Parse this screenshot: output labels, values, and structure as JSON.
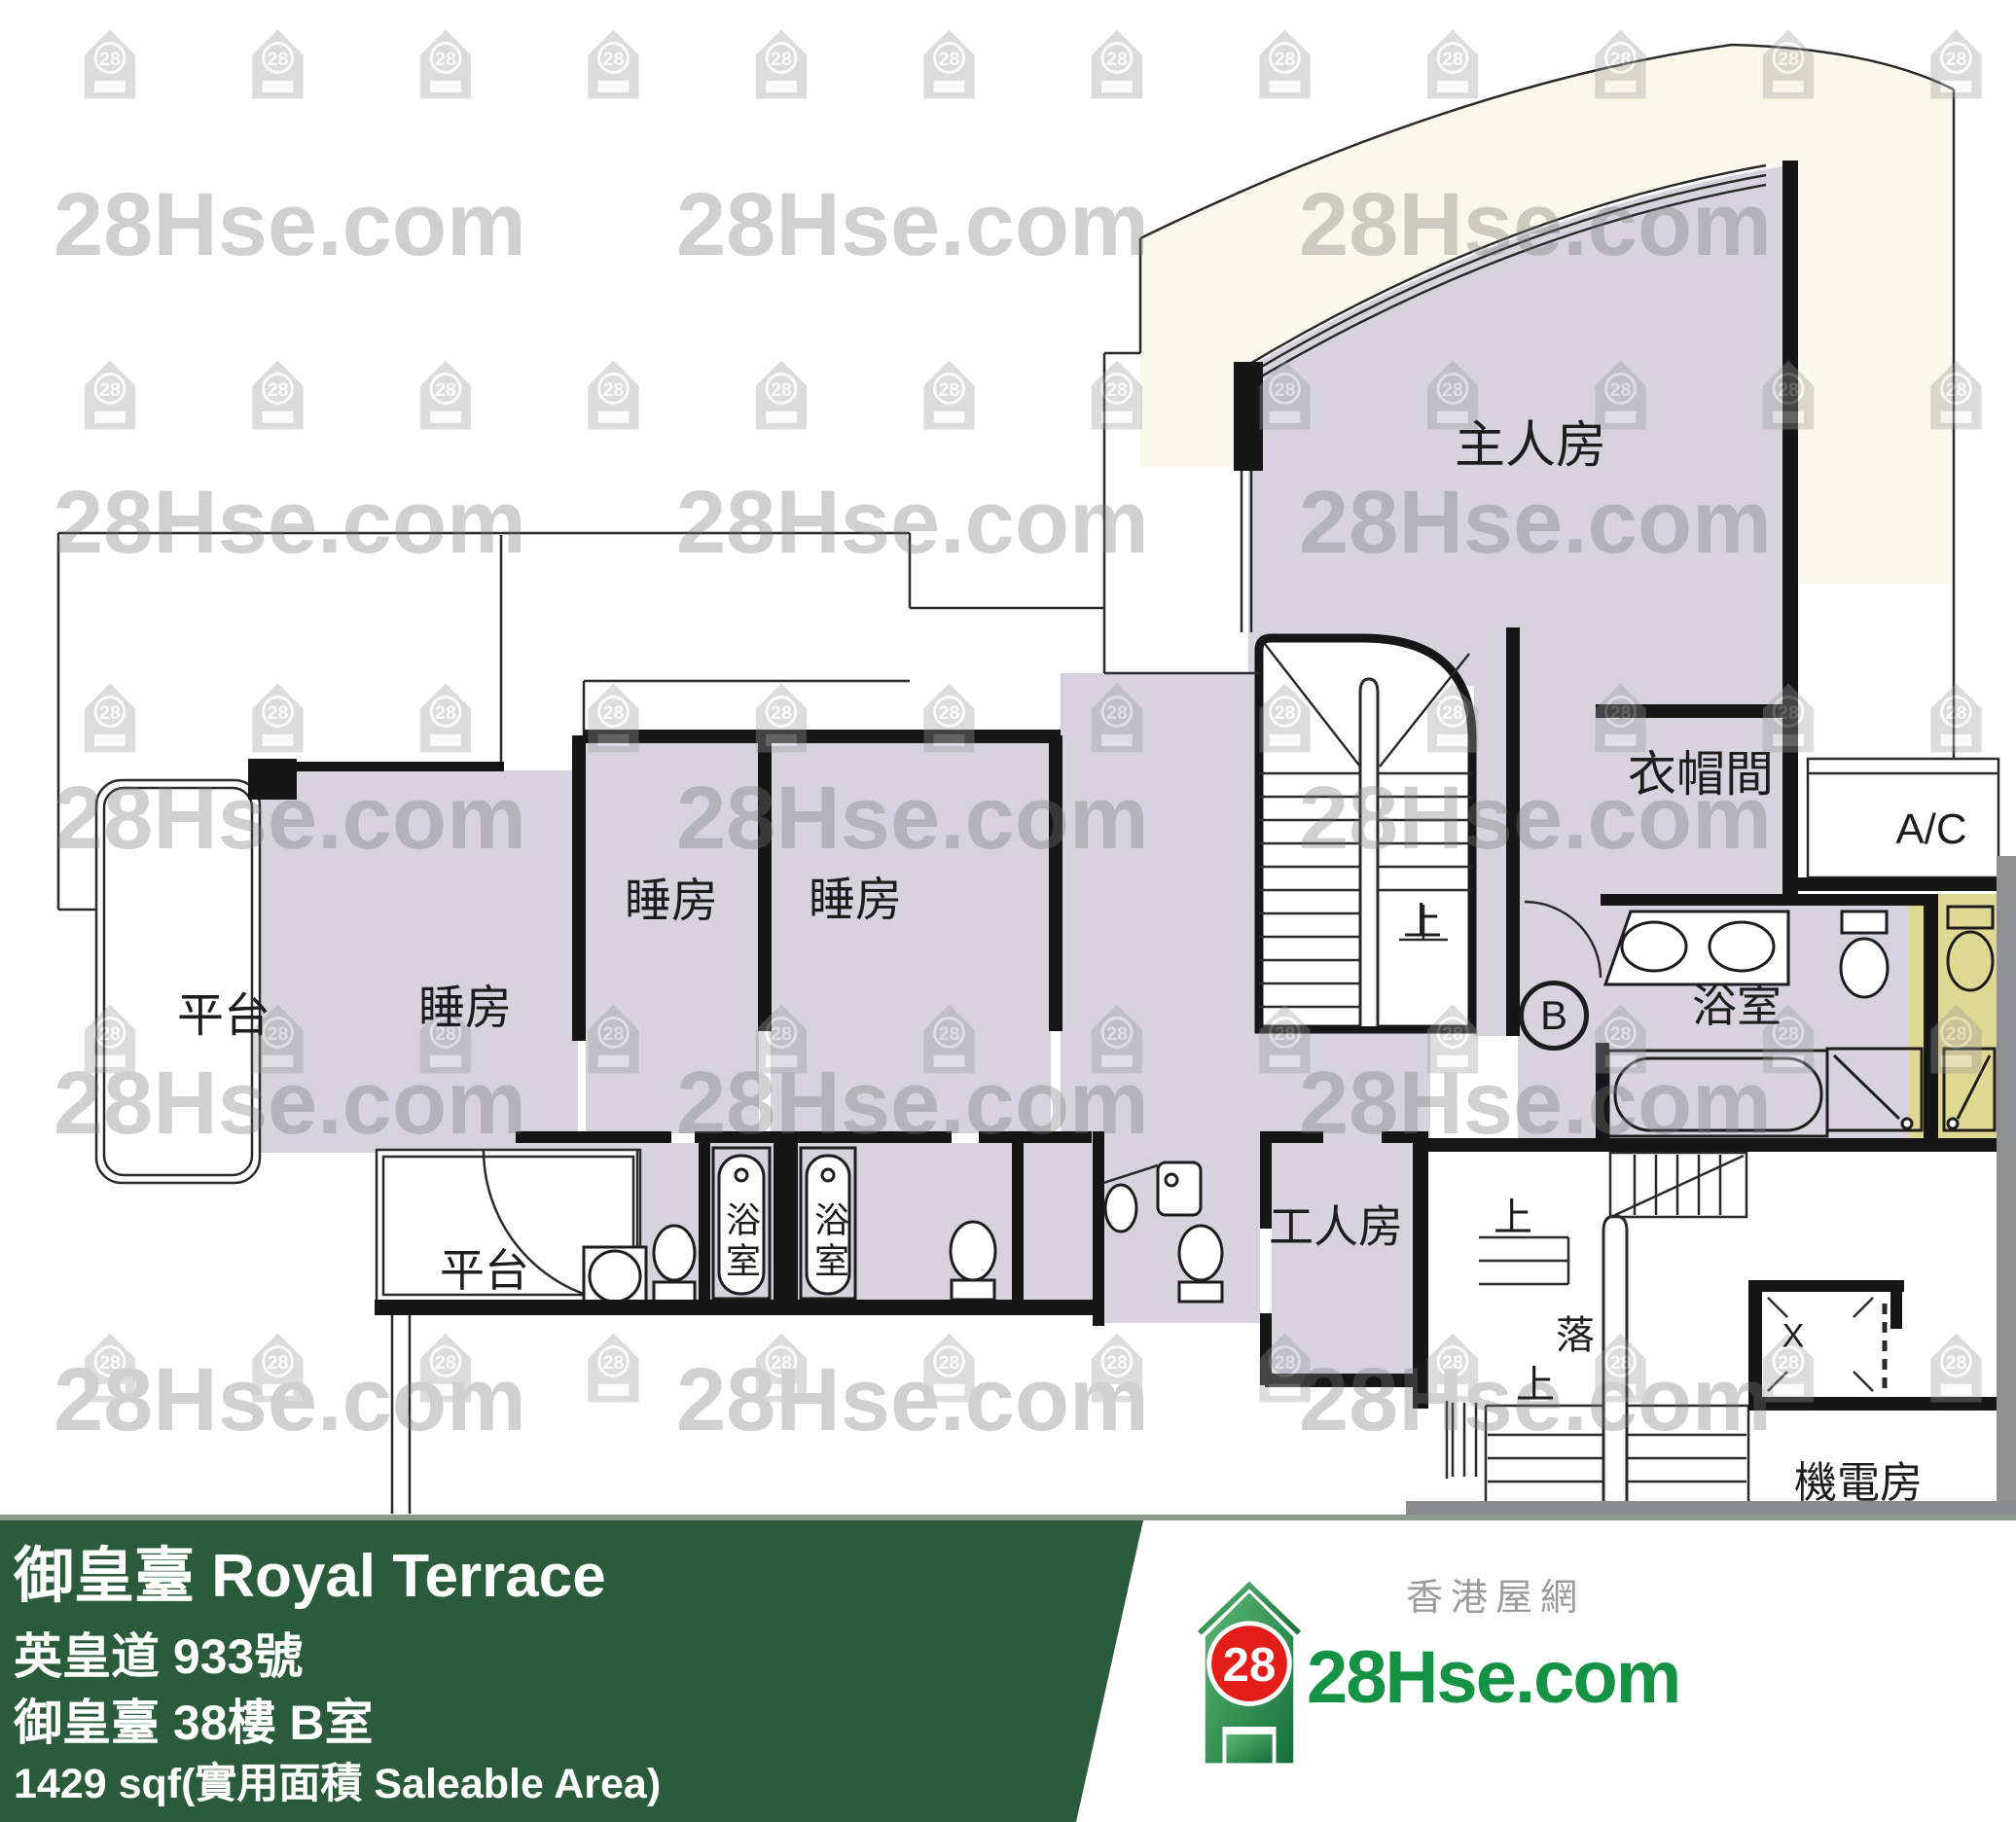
{
  "watermark": {
    "text": "28Hse.com",
    "icon_number": "28"
  },
  "floor_plan": {
    "rooms": {
      "master_bedroom": "主人房",
      "closet": "衣帽間",
      "ac": "A/C",
      "bedroom_1": "睡房",
      "bedroom_2": "睡房",
      "bedroom_3": "睡房",
      "terrace_1": "平台",
      "terrace_2": "平台",
      "maid_room": "工人房",
      "master_bathroom": "浴室",
      "bathroom_1": "浴室",
      "bathroom_2": "浴室",
      "plant_room": "機電房"
    },
    "markers": {
      "unit": "B",
      "stairs_up_internal": "上",
      "stairs_up_1": "上",
      "stairs_down": "落",
      "stairs_up_2": "上",
      "lift": "X"
    }
  },
  "banner": {
    "title": "御皇臺 Royal Terrace",
    "address": "英皇道 933號",
    "unit": "御皇臺 38樓 B室",
    "area": "1429 sqf(實用面積 Saleable Area)"
  },
  "logo": {
    "number": "28",
    "brand": "28Hse.com",
    "site_name": "香港屋網"
  },
  "colors": {
    "banner_green": "#2a5b3a",
    "room_lavender": "#d6d3de",
    "shower_yellow": "#ded892",
    "cream": "#fbf8e9",
    "logo_green": "#169245",
    "logo_red": "#e31e18",
    "watermark_gray": "#9a9a9a"
  }
}
